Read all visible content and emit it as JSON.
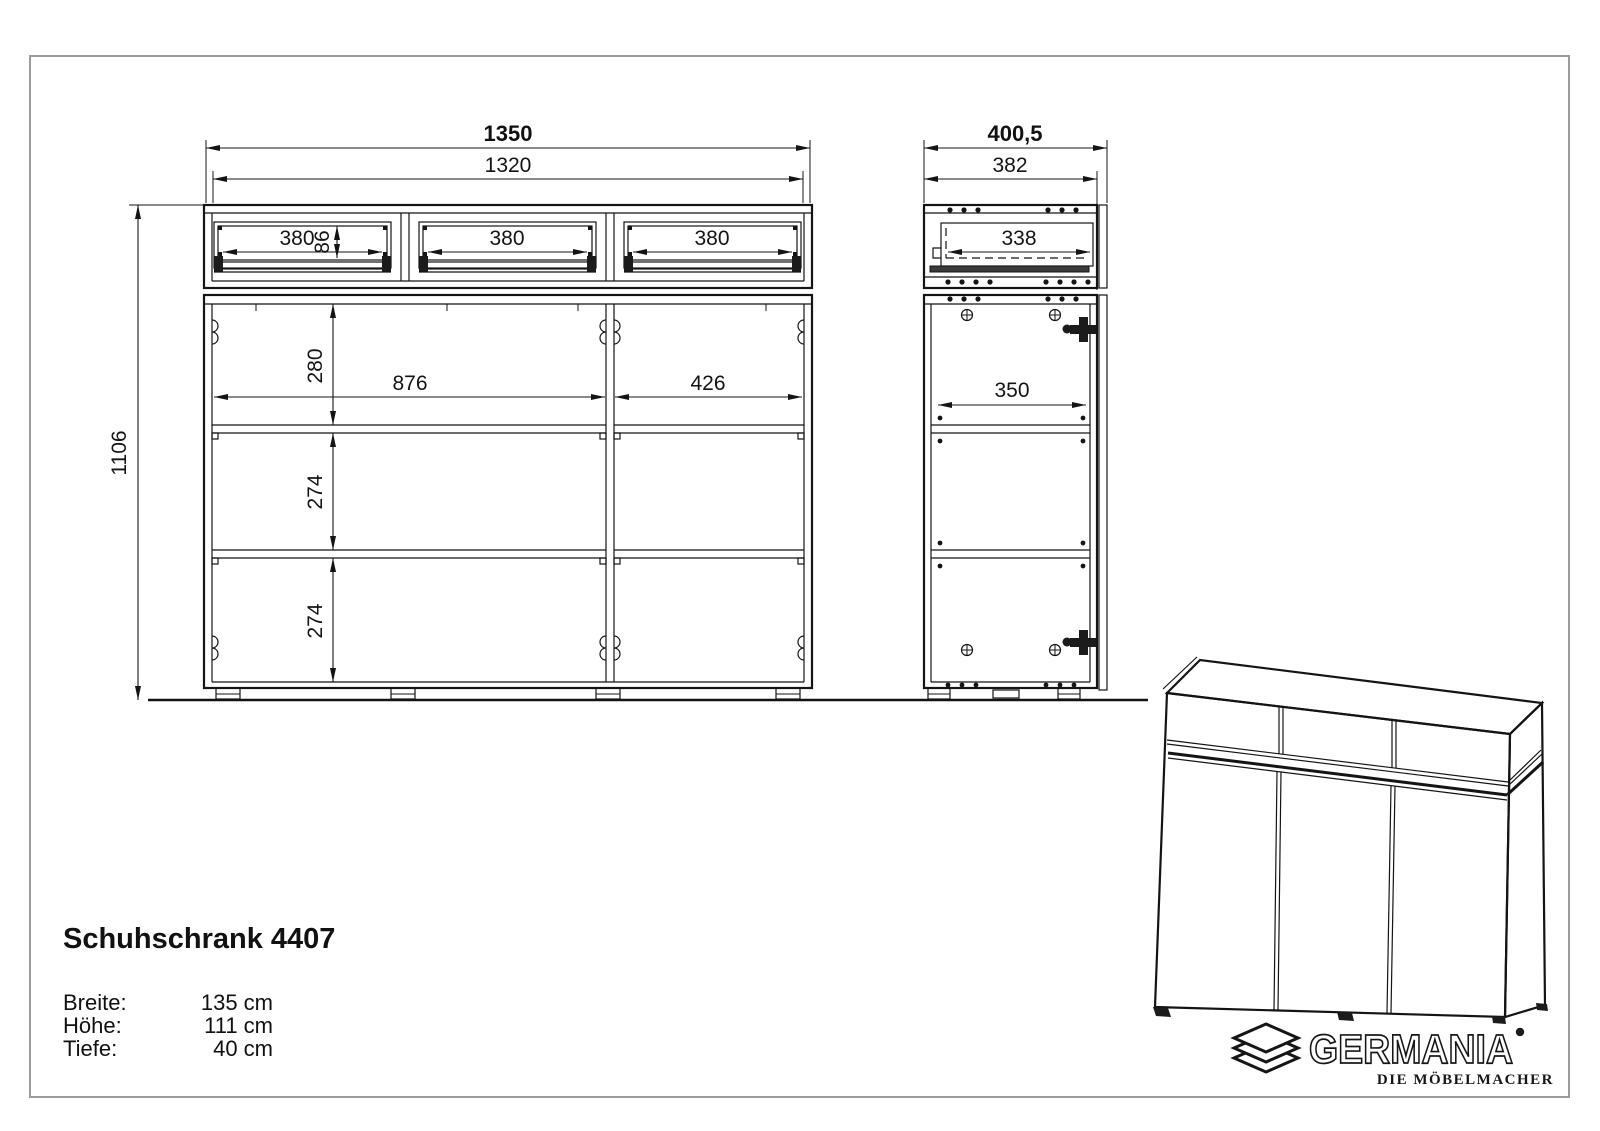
{
  "product": {
    "title": "Schuhschrank 4407"
  },
  "specs": {
    "breite_label": "Breite:",
    "breite_value": "135 cm",
    "hoehe_label": "Höhe:",
    "hoehe_value": "111 cm",
    "tiefe_label": "Tiefe:",
    "tiefe_value": "40 cm"
  },
  "brand": {
    "wordmark": "GERMANIA",
    "tagline": "DIE MÖBELMACHER"
  },
  "drawing": {
    "front": {
      "overall_width": "1350",
      "carcass_width": "1320",
      "drawer1_width": "380",
      "drawer_front_height": "86",
      "drawer2_width": "380",
      "drawer3_width": "380",
      "top_compartment_height": "280",
      "left_compartment_width": "876",
      "right_compartment_width": "426",
      "middle_compartment_height": "274",
      "bottom_compartment_height": "274",
      "overall_height": "1106"
    },
    "side": {
      "overall_depth": "400,5",
      "carcass_depth": "382",
      "drawer_depth": "338",
      "inner_depth": "350"
    }
  }
}
